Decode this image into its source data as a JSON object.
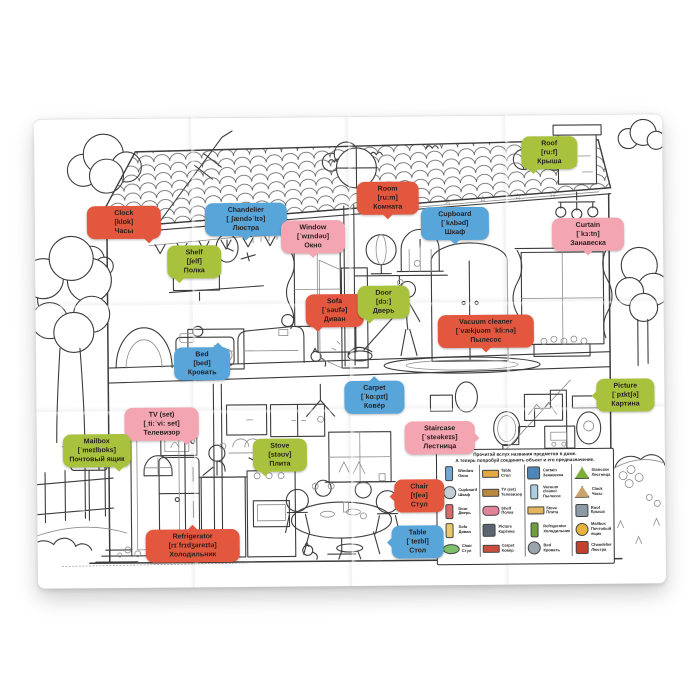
{
  "poster": {
    "title": "House vocabulary coloring poster (EN-RU)",
    "colors": {
      "red": "#e4573f",
      "blue": "#58a5da",
      "green": "#a9c23e",
      "pink": "#f3a5b2"
    },
    "bubbles": [
      {
        "id": "clock",
        "color": "red",
        "tail": "br",
        "x": 52,
        "y": 88,
        "w": 64,
        "en": "Clock",
        "ipa": "[klɒk]",
        "ru": "Часы"
      },
      {
        "id": "chandelier",
        "color": "blue",
        "tail": "b",
        "x": 170,
        "y": 86,
        "w": 72,
        "en": "Chandelier",
        "ipa": "[ˌʃændəˈlɪə]",
        "ru": "Люстра"
      },
      {
        "id": "shelf",
        "color": "green",
        "tail": "bl",
        "x": 132,
        "y": 128,
        "w": 44,
        "en": "Shelf",
        "ipa": "[ʃelf]",
        "ru": "Полка"
      },
      {
        "id": "window",
        "color": "pink",
        "tail": "b",
        "x": 246,
        "y": 104,
        "w": 54,
        "en": "Window",
        "ipa": "[ˈwɪndəʊ]",
        "ru": "Окно"
      },
      {
        "id": "room",
        "color": "red",
        "tail": "b",
        "x": 322,
        "y": 66,
        "w": 52,
        "en": "Room",
        "ipa": "[ru:m]",
        "ru": "Комната"
      },
      {
        "id": "cupboard",
        "color": "blue",
        "tail": "b",
        "x": 386,
        "y": 92,
        "w": 58,
        "en": "Cupboard",
        "ipa": "[ˈkʌbəd]",
        "ru": "Шкаф"
      },
      {
        "id": "roof",
        "color": "green",
        "tail": "bl",
        "x": 487,
        "y": 22,
        "w": 46,
        "en": "Roof",
        "ipa": "[ru:f]",
        "ru": "Крыша"
      },
      {
        "id": "curtain",
        "color": "pink",
        "tail": "b",
        "x": 517,
        "y": 104,
        "w": 62,
        "en": "Curtain",
        "ipa": "[ˈkɜ:tn]",
        "ru": "Занавеска"
      },
      {
        "id": "sofa",
        "color": "red",
        "tail": "bl",
        "x": 270,
        "y": 178,
        "w": 48,
        "en": "Sofa",
        "ipa": "[ˈsəʊfə]",
        "ru": "Диван"
      },
      {
        "id": "door",
        "color": "green",
        "tail": "bl",
        "x": 322,
        "y": 170,
        "w": 42,
        "en": "Door",
        "ipa": "[dɔ:]",
        "ru": "Дверь"
      },
      {
        "id": "bed",
        "color": "blue",
        "tail": "tr",
        "x": 138,
        "y": 230,
        "w": 46,
        "en": "Bed",
        "ipa": "[bed]",
        "ru": "Кровать"
      },
      {
        "id": "vacuum-cleaner",
        "color": "red",
        "tail": "b",
        "x": 402,
        "y": 200,
        "w": 86,
        "en": "Vacuum cleaner",
        "ipa": "[ˈvækjuəm ˈkli:nə]",
        "ru": "Пылесос"
      },
      {
        "id": "carpet",
        "color": "blue",
        "tail": "t",
        "x": 308,
        "y": 265,
        "w": 50,
        "en": "Carpet",
        "ipa": "[ˈkɑ:pɪt]",
        "ru": "Ковёр"
      },
      {
        "id": "staircase",
        "color": "pink",
        "tail": "r",
        "x": 368,
        "y": 306,
        "w": 60,
        "en": "Staircase",
        "ipa": "[ˈsteəkeɪs]",
        "ru": "Лестница"
      },
      {
        "id": "picture",
        "color": "green",
        "tail": "l",
        "x": 560,
        "y": 265,
        "w": 48,
        "en": "Picture",
        "ipa": "[ˈpɪktʃə]",
        "ru": "Картина"
      },
      {
        "id": "tv-set",
        "color": "pink",
        "tail": "br",
        "x": 88,
        "y": 290,
        "w": 64,
        "en": "TV (set)",
        "ipa": "[ˌti:ˈvi: set]",
        "ru": "Телевизор"
      },
      {
        "id": "mailbox",
        "color": "green",
        "tail": "br",
        "x": 26,
        "y": 316,
        "w": 58,
        "en": "Mailbox",
        "ipa": "[ˈmeɪlbɒks]",
        "ru": "Почтовый ящик"
      },
      {
        "id": "stove",
        "color": "green",
        "tail": "bl",
        "x": 216,
        "y": 322,
        "w": 44,
        "en": "Stove",
        "ipa": "[stəʊv]",
        "ru": "Плита"
      },
      {
        "id": "chair",
        "color": "red",
        "tail": "l",
        "x": 357,
        "y": 364,
        "w": 40,
        "en": "Chair",
        "ipa": "[tʃeə]",
        "ru": "Стул"
      },
      {
        "id": "table",
        "color": "blue",
        "tail": "l",
        "x": 354,
        "y": 410,
        "w": 42,
        "en": "Table",
        "ipa": "[ˈteɪbl]",
        "ru": "Стол"
      },
      {
        "id": "refrigerator",
        "color": "red",
        "tail": "t",
        "x": 108,
        "y": 412,
        "w": 84,
        "en": "Refrigerator",
        "ipa": "[rɪˈfrɪdʒəreɪtə]",
        "ru": "Холодильник"
      }
    ],
    "legend": {
      "header_line1": "Прочитай вслух названия предметов в доме.",
      "header_line2": "А теперь попробуй соединить объект и его предназначение.",
      "columns": [
        {
          "items": [
            {
              "icon": "curtain-icon",
              "shape": "tall",
              "color": "#6fa8d6",
              "en": "Window",
              "ru": "Окно"
            },
            {
              "icon": "ball-icon",
              "shape": "circle",
              "color": "#c3cdd6",
              "en": "Cupboard",
              "ru": "Шкаф"
            },
            {
              "icon": "chair-icon",
              "shape": "tall",
              "color": "#d96a6a",
              "en": "Door",
              "ru": "Дверь"
            },
            {
              "icon": "wardrobe-icon",
              "shape": "tall",
              "color": "#eac96d",
              "en": "Sofa",
              "ru": "Диван"
            },
            {
              "icon": "table-icon",
              "shape": "oval",
              "color": "#7cc06c",
              "en": "Chair",
              "ru": "Стул"
            }
          ]
        },
        {
          "items": [
            {
              "icon": "shelf-icon",
              "shape": "wide",
              "color": "#e2a93f",
              "en": "Table",
              "ru": "Стол"
            },
            {
              "icon": "picture-icon",
              "shape": "wide",
              "color": "#b98a3e",
              "en": "TV (set)",
              "ru": "Телевизор"
            },
            {
              "icon": "sofa-icon",
              "shape": "sofa",
              "color": "#e0849a",
              "en": "Shelf",
              "ru": "Полка"
            },
            {
              "icon": "tv-icon",
              "shape": "box",
              "color": "#5a6470",
              "en": "Picture",
              "ru": "Картина"
            },
            {
              "icon": "carpet-icon",
              "shape": "wide",
              "color": "#cc4b3f",
              "en": "Carpet",
              "ru": "Ковёр"
            }
          ]
        },
        {
          "items": [
            {
              "icon": "stove-icon",
              "shape": "box",
              "color": "#4f86b8",
              "en": "Curtain",
              "ru": "Занавеска"
            },
            {
              "icon": "fridge-icon",
              "shape": "tall",
              "color": "#a9d0e2",
              "en": "Vacuum cleaner",
              "ru": "Пылесос"
            },
            {
              "icon": "bed-icon",
              "shape": "wide",
              "color": "#e3b65c",
              "en": "Stove",
              "ru": "Плита"
            },
            {
              "icon": "bottle-icon",
              "shape": "tall",
              "color": "#6f9e3f",
              "en": "Refrigerator",
              "ru": "Холодильник"
            },
            {
              "icon": "vacuum-icon",
              "shape": "circle",
              "color": "#9aa4ad",
              "en": "Bed",
              "ru": "Кровать"
            }
          ]
        },
        {
          "items": [
            {
              "icon": "chandelier-icon",
              "shape": "mound",
              "color": "#7cae3a",
              "en": "Staircase",
              "ru": "Лестница"
            },
            {
              "icon": "roof-icon",
              "shape": "mound",
              "color": "#c9a46a",
              "en": "Clock",
              "ru": "Часы"
            },
            {
              "icon": "brick-icon",
              "shape": "box",
              "color": "#8e9aa3",
              "en": "Roof",
              "ru": "Крыша"
            },
            {
              "icon": "clock-icon",
              "shape": "circle",
              "color": "#e6b33c",
              "en": "Mailbox",
              "ru": "Почтовый ящик"
            },
            {
              "icon": "mailbox-icon",
              "shape": "box",
              "color": "#c6402e",
              "en": "Chandelier",
              "ru": "Люстра"
            }
          ]
        }
      ]
    }
  }
}
